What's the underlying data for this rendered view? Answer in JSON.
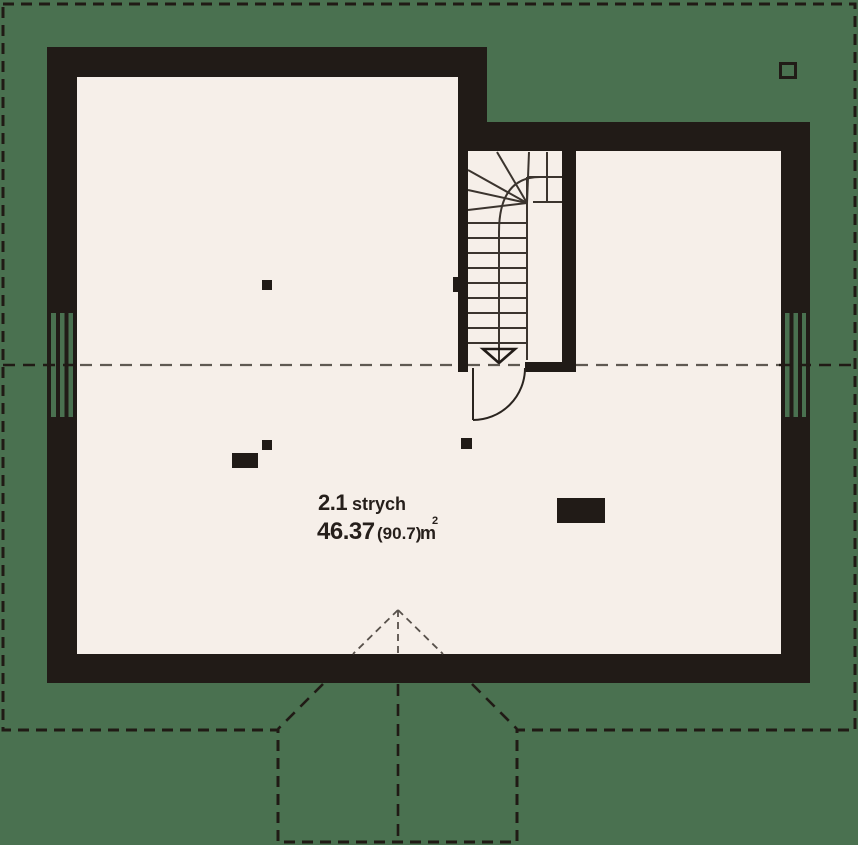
{
  "plan": {
    "type": "attic-floor-plan",
    "room": {
      "number": "2.1",
      "name": "strych",
      "area": "46.37",
      "area_alt": "(90.7)",
      "unit": "m",
      "unit_sup": "2"
    },
    "colors": {
      "background": "#4a7150",
      "floor": "#f6efe9",
      "wall": "#211b17",
      "dash_dark": "#201a15",
      "dash_gray": "#5f5952",
      "gable_gray": "#58514b",
      "stair_line": "#3b342e",
      "text": "#261f1b"
    }
  }
}
